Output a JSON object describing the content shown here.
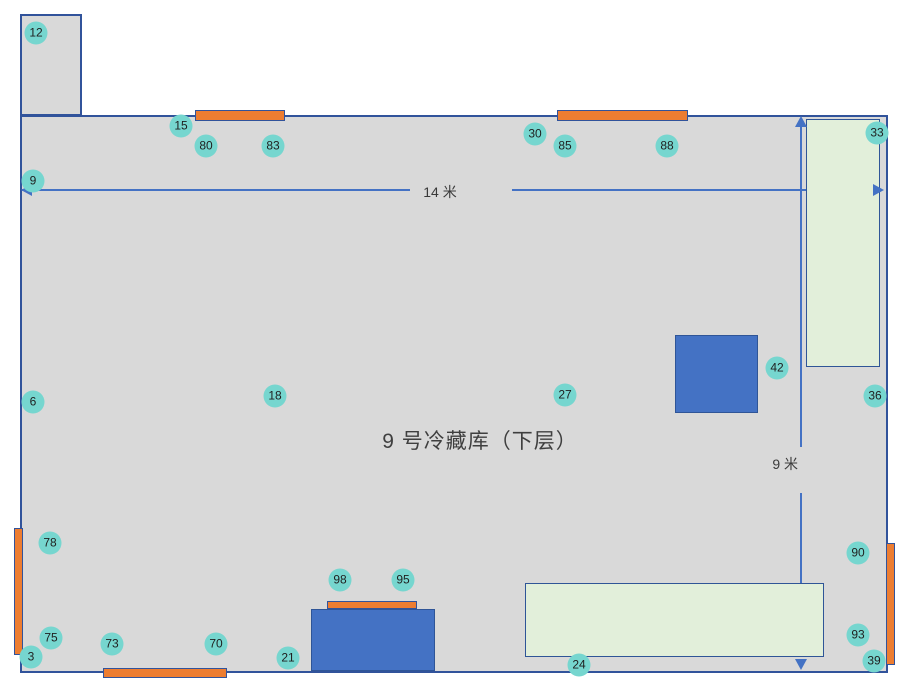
{
  "title": "9 号冷藏库（下层）",
  "colors": {
    "floor_fill": "#d9d9d9",
    "wall_stroke": "#31539b",
    "door_orange": "#ed7d31",
    "equipment_blue": "#4472c4",
    "zone_green": "#e2efda",
    "marker_teal": "#76d6cf",
    "dimension_blue": "#4472c4"
  },
  "rooms": {
    "annex": {
      "x": 20,
      "y": 14,
      "w": 62,
      "h": 102
    },
    "main": {
      "x": 20,
      "y": 115,
      "w": 868,
      "h": 558
    }
  },
  "dimensions": [
    {
      "name": "room-width",
      "label": "14 米"
    },
    {
      "name": "room-height",
      "label": "9 米"
    }
  ],
  "shapes": {
    "green_zones": [
      {
        "x": 806,
        "y": 119,
        "w": 74,
        "h": 248
      },
      {
        "x": 525,
        "y": 583,
        "w": 299,
        "h": 74
      }
    ],
    "blue_blocks": [
      {
        "x": 675,
        "y": 335,
        "w": 83,
        "h": 78
      },
      {
        "x": 311,
        "y": 609,
        "w": 124,
        "h": 62
      }
    ],
    "orange_bars": [
      {
        "x": 195,
        "y": 110,
        "w": 90,
        "h": 11
      },
      {
        "x": 557,
        "y": 110,
        "w": 131,
        "h": 11
      },
      {
        "x": 14,
        "y": 528,
        "w": 9,
        "h": 127
      },
      {
        "x": 886,
        "y": 543,
        "w": 9,
        "h": 122
      },
      {
        "x": 103,
        "y": 668,
        "w": 124,
        "h": 10
      },
      {
        "x": 327,
        "y": 601,
        "w": 90,
        "h": 8
      }
    ]
  },
  "markers": [
    {
      "id": "12",
      "x": 36,
      "y": 33
    },
    {
      "id": "15",
      "x": 181,
      "y": 126
    },
    {
      "id": "80",
      "x": 206,
      "y": 146
    },
    {
      "id": "83",
      "x": 273,
      "y": 146
    },
    {
      "id": "30",
      "x": 535,
      "y": 134
    },
    {
      "id": "85",
      "x": 565,
      "y": 146
    },
    {
      "id": "88",
      "x": 667,
      "y": 146
    },
    {
      "id": "33",
      "x": 877,
      "y": 133
    },
    {
      "id": "9",
      "x": 33,
      "y": 181
    },
    {
      "id": "6",
      "x": 33,
      "y": 402
    },
    {
      "id": "18",
      "x": 275,
      "y": 396
    },
    {
      "id": "27",
      "x": 565,
      "y": 395
    },
    {
      "id": "42",
      "x": 777,
      "y": 368
    },
    {
      "id": "36",
      "x": 875,
      "y": 396
    },
    {
      "id": "78",
      "x": 50,
      "y": 543
    },
    {
      "id": "90",
      "x": 858,
      "y": 553
    },
    {
      "id": "98",
      "x": 340,
      "y": 580
    },
    {
      "id": "95",
      "x": 403,
      "y": 580
    },
    {
      "id": "75",
      "x": 51,
      "y": 638
    },
    {
      "id": "73",
      "x": 112,
      "y": 644
    },
    {
      "id": "70",
      "x": 216,
      "y": 644
    },
    {
      "id": "21",
      "x": 288,
      "y": 658
    },
    {
      "id": "24",
      "x": 579,
      "y": 665
    },
    {
      "id": "93",
      "x": 858,
      "y": 635
    },
    {
      "id": "3",
      "x": 31,
      "y": 657
    },
    {
      "id": "39",
      "x": 874,
      "y": 661
    }
  ]
}
